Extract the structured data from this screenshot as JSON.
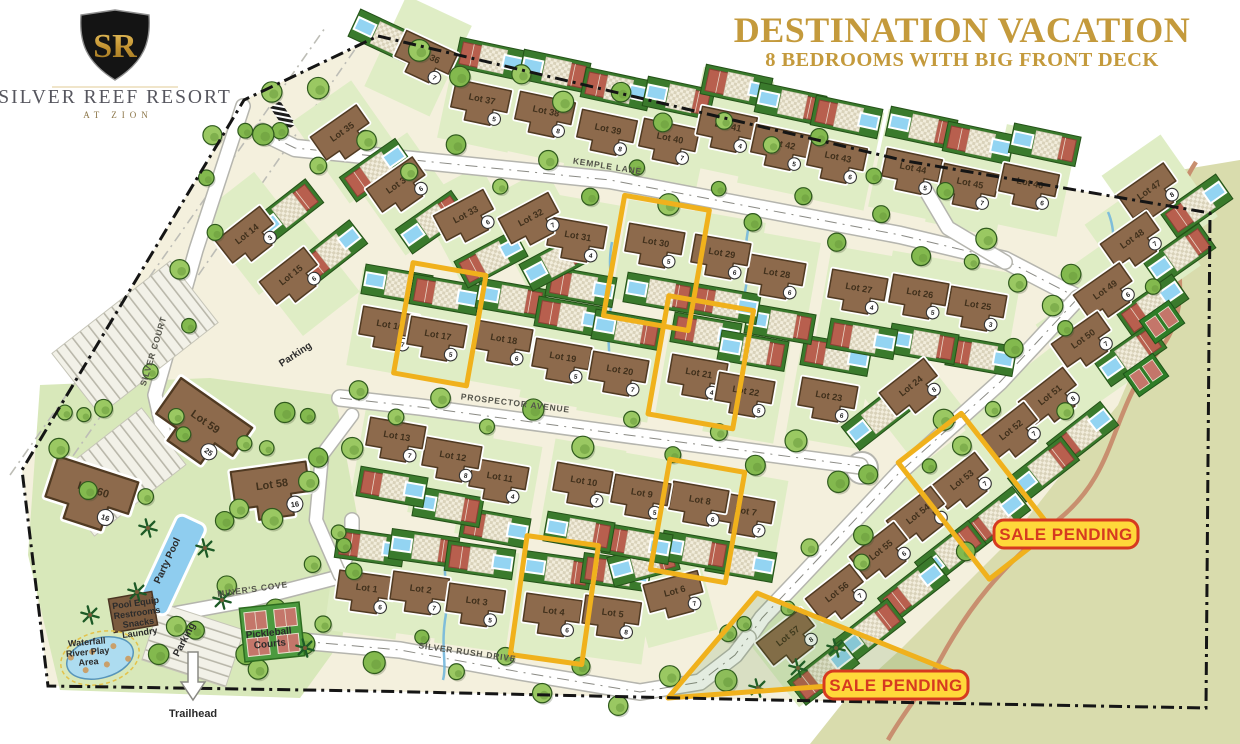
{
  "branding": {
    "monogram": "SR",
    "name": "SILVER REEF RESORT",
    "tagline": "AT ZION"
  },
  "title": {
    "main": "DESTINATION VACATION",
    "subtitle": "8 BEDROOMS WITH BIG FRONT DECK",
    "color": "#c49a3c"
  },
  "colors": {
    "highlight_yellow": "#f0b11c",
    "pending_red": "#d63a20",
    "pending_bg": "#ffd83a",
    "house_brown": "#8d6a4c",
    "desert_tan": "#d9dcad"
  },
  "sale_pending": {
    "label": "SALE PENDING",
    "badges": [
      {
        "x": 1066,
        "y": 534
      },
      {
        "x": 896,
        "y": 685
      }
    ]
  },
  "streets": [
    {
      "name": "KEMPLE LANE",
      "x": 607,
      "y": 169,
      "rot": 9
    },
    {
      "name": "PROSPECTOR AVENUE",
      "x": 515,
      "y": 406,
      "rot": 7
    },
    {
      "name": "SILVER RUSH DRIVE",
      "x": 467,
      "y": 655,
      "rot": 8
    },
    {
      "name": "MINER'S COVE",
      "x": 253,
      "y": 592,
      "rot": -8
    },
    {
      "name": "SILVER COURT",
      "x": 156,
      "y": 352,
      "rot": -73
    }
  ],
  "amenities": [
    {
      "lines": [
        "Party Pool"
      ],
      "x": 170,
      "y": 562,
      "rot": -65,
      "size": 10
    },
    {
      "lines": [
        "Pickleball",
        "Courts"
      ],
      "x": 269,
      "y": 636,
      "rot": -6,
      "size": 10
    },
    {
      "lines": [
        "Pool Equip",
        "Restrooms",
        "Snacks",
        "Laundry"
      ],
      "x": 136,
      "y": 606,
      "rot": -8,
      "size": 9
    },
    {
      "lines": [
        "Waterfall",
        "River Play",
        "Area"
      ],
      "x": 87,
      "y": 645,
      "rot": -5,
      "size": 9
    },
    {
      "lines": [
        "Parking"
      ],
      "x": 297,
      "y": 357,
      "rot": -33,
      "size": 10
    },
    {
      "lines": [
        "Parking"
      ],
      "x": 187,
      "y": 641,
      "rot": -62,
      "size": 10
    },
    {
      "lines": [
        "Trailhead"
      ],
      "x": 193,
      "y": 717,
      "rot": 0,
      "size": 11
    }
  ],
  "lots": [
    {
      "label": "Lot 1",
      "unit": "6",
      "x": 366,
      "y": 593,
      "r": 8,
      "ad": -85
    },
    {
      "label": "Lot 2",
      "unit": "7",
      "x": 420,
      "y": 594,
      "r": 8,
      "ad": -85
    },
    {
      "label": "Lot 3",
      "unit": "5",
      "x": 476,
      "y": 606,
      "r": 8,
      "ad": -85
    },
    {
      "label": "Lot 4",
      "unit": "6",
      "x": 553,
      "y": 616,
      "r": 8,
      "ad": -85,
      "hl": {
        "w": 72,
        "h": 120
      }
    },
    {
      "label": "Lot 5",
      "unit": "8",
      "x": 612,
      "y": 618,
      "r": 8,
      "ad": -85
    },
    {
      "label": "Lot 6",
      "unit": "7",
      "x": 676,
      "y": 596,
      "r": -15,
      "ad": -135
    },
    {
      "label": "Lot 7",
      "unit": "7",
      "x": 745,
      "y": 516,
      "r": 10,
      "ad": 95
    },
    {
      "label": "Lot 8",
      "unit": "6",
      "x": 699,
      "y": 505,
      "r": 10,
      "ad": 95,
      "hl": {
        "w": 76,
        "h": 112
      }
    },
    {
      "label": "Lot 9",
      "unit": "5",
      "x": 641,
      "y": 498,
      "r": 10,
      "ad": 95
    },
    {
      "label": "Lot 10",
      "unit": "7",
      "x": 583,
      "y": 486,
      "r": 10,
      "ad": 95
    },
    {
      "label": "Lot 11",
      "unit": "4",
      "x": 499,
      "y": 482,
      "r": 10,
      "ad": 95
    },
    {
      "label": "Lot 12",
      "unit": "8",
      "x": 452,
      "y": 461,
      "r": 10,
      "ad": 95
    },
    {
      "label": "Lot 13",
      "unit": "7",
      "x": 396,
      "y": 441,
      "r": 10,
      "ad": 95
    },
    {
      "label": "Lot 14",
      "unit": "3",
      "x": 250,
      "y": 238,
      "r": -38,
      "ad": -35
    },
    {
      "label": "Lot 15",
      "unit": "6",
      "x": 294,
      "y": 279,
      "r": -38,
      "ad": -35
    },
    {
      "label": "Lot 16",
      "unit": "7",
      "x": 389,
      "y": 330,
      "r": 10,
      "ad": -80
    },
    {
      "label": "Lot 17",
      "unit": "5",
      "x": 437,
      "y": 340,
      "r": 10,
      "ad": -80,
      "hl": {
        "w": 74,
        "h": 112
      }
    },
    {
      "label": "Lot 18",
      "unit": "6",
      "x": 503,
      "y": 344,
      "r": 10,
      "ad": -80
    },
    {
      "label": "Lot 19",
      "unit": "5",
      "x": 562,
      "y": 362,
      "r": 10,
      "ad": -80
    },
    {
      "label": "Lot 20",
      "unit": "7",
      "x": 619,
      "y": 375,
      "r": 10,
      "ad": -80
    },
    {
      "label": "Lot 21",
      "unit": "4",
      "x": 698,
      "y": 378,
      "r": 10,
      "ad": -80,
      "hl": {
        "w": 86,
        "h": 120
      }
    },
    {
      "label": "Lot 22",
      "unit": "5",
      "x": 745,
      "y": 396,
      "r": 10,
      "ad": -80
    },
    {
      "label": "Lot 23",
      "unit": "6",
      "x": 828,
      "y": 401,
      "r": 10,
      "ad": -80
    },
    {
      "label": "Lot 24",
      "unit": "8",
      "x": 914,
      "y": 390,
      "r": -38,
      "ad": 143
    },
    {
      "label": "Lot 25",
      "unit": "3",
      "x": 977,
      "y": 310,
      "r": 10,
      "ad": 85
    },
    {
      "label": "Lot 26",
      "unit": "5",
      "x": 919,
      "y": 298,
      "r": 10,
      "ad": 85
    },
    {
      "label": "Lot 27",
      "unit": "4",
      "x": 858,
      "y": 293,
      "r": 10,
      "ad": 85
    },
    {
      "label": "Lot 28",
      "unit": "6",
      "x": 776,
      "y": 278,
      "r": 10,
      "ad": 85
    },
    {
      "label": "Lot 29",
      "unit": "6",
      "x": 721,
      "y": 258,
      "r": 10,
      "ad": 85
    },
    {
      "label": "Lot 30",
      "unit": "5",
      "x": 655,
      "y": 247,
      "r": 10,
      "ad": 85,
      "hl": {
        "w": 86,
        "h": 122
      }
    },
    {
      "label": "Lot 31",
      "unit": "4",
      "x": 577,
      "y": 241,
      "r": 10,
      "ad": 85
    },
    {
      "label": "Lot 32",
      "unit": "7",
      "x": 533,
      "y": 222,
      "r": -28,
      "ad": 60
    },
    {
      "label": "Lot 33",
      "unit": "6",
      "x": 468,
      "y": 219,
      "r": -28,
      "ad": 60
    },
    {
      "label": "Lot 34",
      "unit": "6",
      "x": 401,
      "y": 188,
      "r": -35,
      "ad": 48
    },
    {
      "label": "Lot 35",
      "unit": "3",
      "x": 345,
      "y": 136,
      "r": -35,
      "ad": 48
    },
    {
      "label": "Lot 36",
      "unit": "7",
      "x": 425,
      "y": 60,
      "r": 25,
      "ad": -150
    },
    {
      "label": "Lot 37",
      "unit": "5",
      "x": 481,
      "y": 104,
      "r": 12,
      "ad": -78
    },
    {
      "label": "Lot 38",
      "unit": "8",
      "x": 545,
      "y": 116,
      "r": 12,
      "ad": -78
    },
    {
      "label": "Lot 39",
      "unit": "8",
      "x": 607,
      "y": 134,
      "r": 12,
      "ad": -78
    },
    {
      "label": "Lot 40",
      "unit": "7",
      "x": 669,
      "y": 143,
      "r": 12,
      "ad": -78
    },
    {
      "label": "Lot 41",
      "unit": "4",
      "x": 727,
      "y": 131,
      "r": 12,
      "ad": -78
    },
    {
      "label": "Lot 42",
      "unit": "5",
      "x": 781,
      "y": 149,
      "r": 12,
      "ad": -78
    },
    {
      "label": "Lot 43",
      "unit": "6",
      "x": 837,
      "y": 162,
      "r": 12,
      "ad": -78
    },
    {
      "label": "Lot 44",
      "unit": "5",
      "x": 912,
      "y": 173,
      "r": 12,
      "ad": -78
    },
    {
      "label": "Lot 45",
      "unit": "7",
      "x": 969,
      "y": 188,
      "r": 12,
      "ad": -78
    },
    {
      "label": "Lot 46",
      "unit": "6",
      "x": 1029,
      "y": 188,
      "r": 12,
      "ad": -70
    },
    {
      "label": "Lot 47",
      "unit": "8",
      "x": 1152,
      "y": 194,
      "r": -35,
      "ad": 15
    },
    {
      "label": "Lot 48",
      "unit": "7",
      "x": 1135,
      "y": 243,
      "r": -35,
      "ad": 15
    },
    {
      "label": "Lot 49",
      "unit": "6",
      "x": 1108,
      "y": 294,
      "r": -35,
      "ad": 15
    },
    {
      "label": "Lot 50",
      "unit": "7",
      "x": 1086,
      "y": 343,
      "r": -35,
      "ad": 15
    },
    {
      "label": "Lot 51",
      "unit": "8",
      "x": 1053,
      "y": 399,
      "r": -38,
      "ad": 50
    },
    {
      "label": "Lot 52",
      "unit": "7",
      "x": 1014,
      "y": 434,
      "r": -38,
      "ad": 50
    },
    {
      "label": "Lot 53",
      "unit": "7",
      "x": 965,
      "y": 484,
      "r": -38,
      "ad": 50,
      "hl": {
        "w": 80,
        "h": 148
      }
    },
    {
      "label": "Lot 54",
      "unit": "8",
      "x": 921,
      "y": 518,
      "r": -38,
      "ad": 50
    },
    {
      "label": "Lot 55",
      "unit": "6",
      "x": 884,
      "y": 554,
      "r": -38,
      "ad": 50
    },
    {
      "label": "Lot 56",
      "unit": "7",
      "x": 840,
      "y": 596,
      "r": -38,
      "ad": 50
    },
    {
      "label": "Lot 57",
      "unit": "8",
      "x": 791,
      "y": 640,
      "r": -38,
      "ad": 45
    },
    {
      "label": "Lot 58",
      "unit": "16",
      "x": 273,
      "y": 492,
      "r": -8,
      "ad": null,
      "s": 1.35
    },
    {
      "label": "Lot 59",
      "unit": "25",
      "x": 201,
      "y": 428,
      "r": 35,
      "ad": null,
      "s": 1.55
    },
    {
      "label": "Lot 60",
      "unit": "16",
      "x": 91,
      "y": 497,
      "r": 18,
      "ad": null,
      "s": 1.5
    }
  ],
  "pending_triangle": [
    [
      757,
      593
    ],
    [
      963,
      676
    ],
    [
      668,
      698
    ]
  ]
}
